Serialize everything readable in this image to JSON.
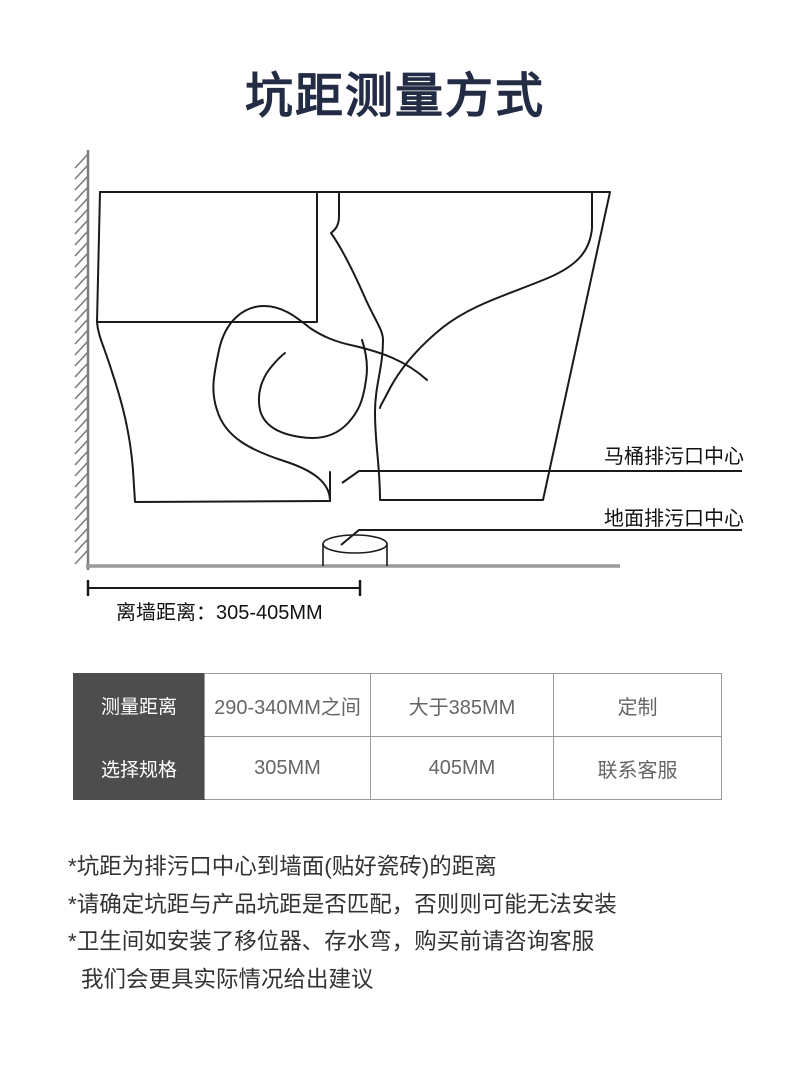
{
  "title": "坑距测量方式",
  "diagram": {
    "label_toilet_outlet": "马桶排污口中心",
    "label_floor_outlet": "地面排污口中心",
    "dimension_label": "离墙距离：305-405MM"
  },
  "table": {
    "rows": [
      {
        "header": "测量距离",
        "cells": [
          "290-340MM之间",
          "大于385MM",
          "定制"
        ]
      },
      {
        "header": "选择规格",
        "cells": [
          "305MM",
          "405MM",
          "联系客服"
        ]
      }
    ]
  },
  "notes": [
    "*坑距为排污口中心到墙面(贴好瓷砖)的距离",
    "*请确定坑距与产品坑距是否匹配，否则则可能无法安装",
    "*卫生间如安装了移位器、存水弯，购买前请咨询客服",
    "我们会更具实际情况给出建议"
  ],
  "colors": {
    "title": "#222c44",
    "line_art": "#1a1a1a",
    "wall": "#7d7d7d",
    "floor": "#9a9a9a",
    "table_header_bg": "#4d4d4d",
    "table_border": "#999999",
    "table_cell_text": "#666666",
    "note_text": "#333333"
  }
}
